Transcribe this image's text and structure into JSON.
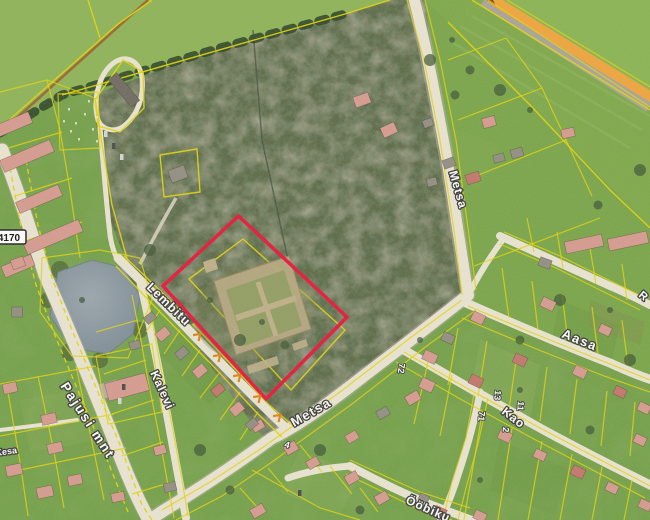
{
  "map": {
    "description": "aerial orthophoto with cadastral parcel overlay and selected plot outline",
    "colors": {
      "selection_outline": "#E8173A",
      "cadastral_lines": "#E3D606",
      "boundary_markers": "#E08318",
      "main_road_fill": "#F0A53C",
      "water": "#8A98A0"
    },
    "road_badge": {
      "number": "4170"
    },
    "street_labels": {
      "pajusi": "Pajusi mnt",
      "lembitu": "Lembitu",
      "kalevi": "Kalevi",
      "metsa_north": "Metsa",
      "metsa_south": "Metsa",
      "aasa": "Aasa",
      "kao": "Kao",
      "oobiku": "Ööbiku",
      "kesa_partial": "Kesa",
      "r_partial": "R"
    },
    "house_numbers": {
      "n72": "72",
      "n13": "13",
      "n11": "11",
      "n71": "71",
      "n2": "2",
      "n4": "4"
    }
  }
}
